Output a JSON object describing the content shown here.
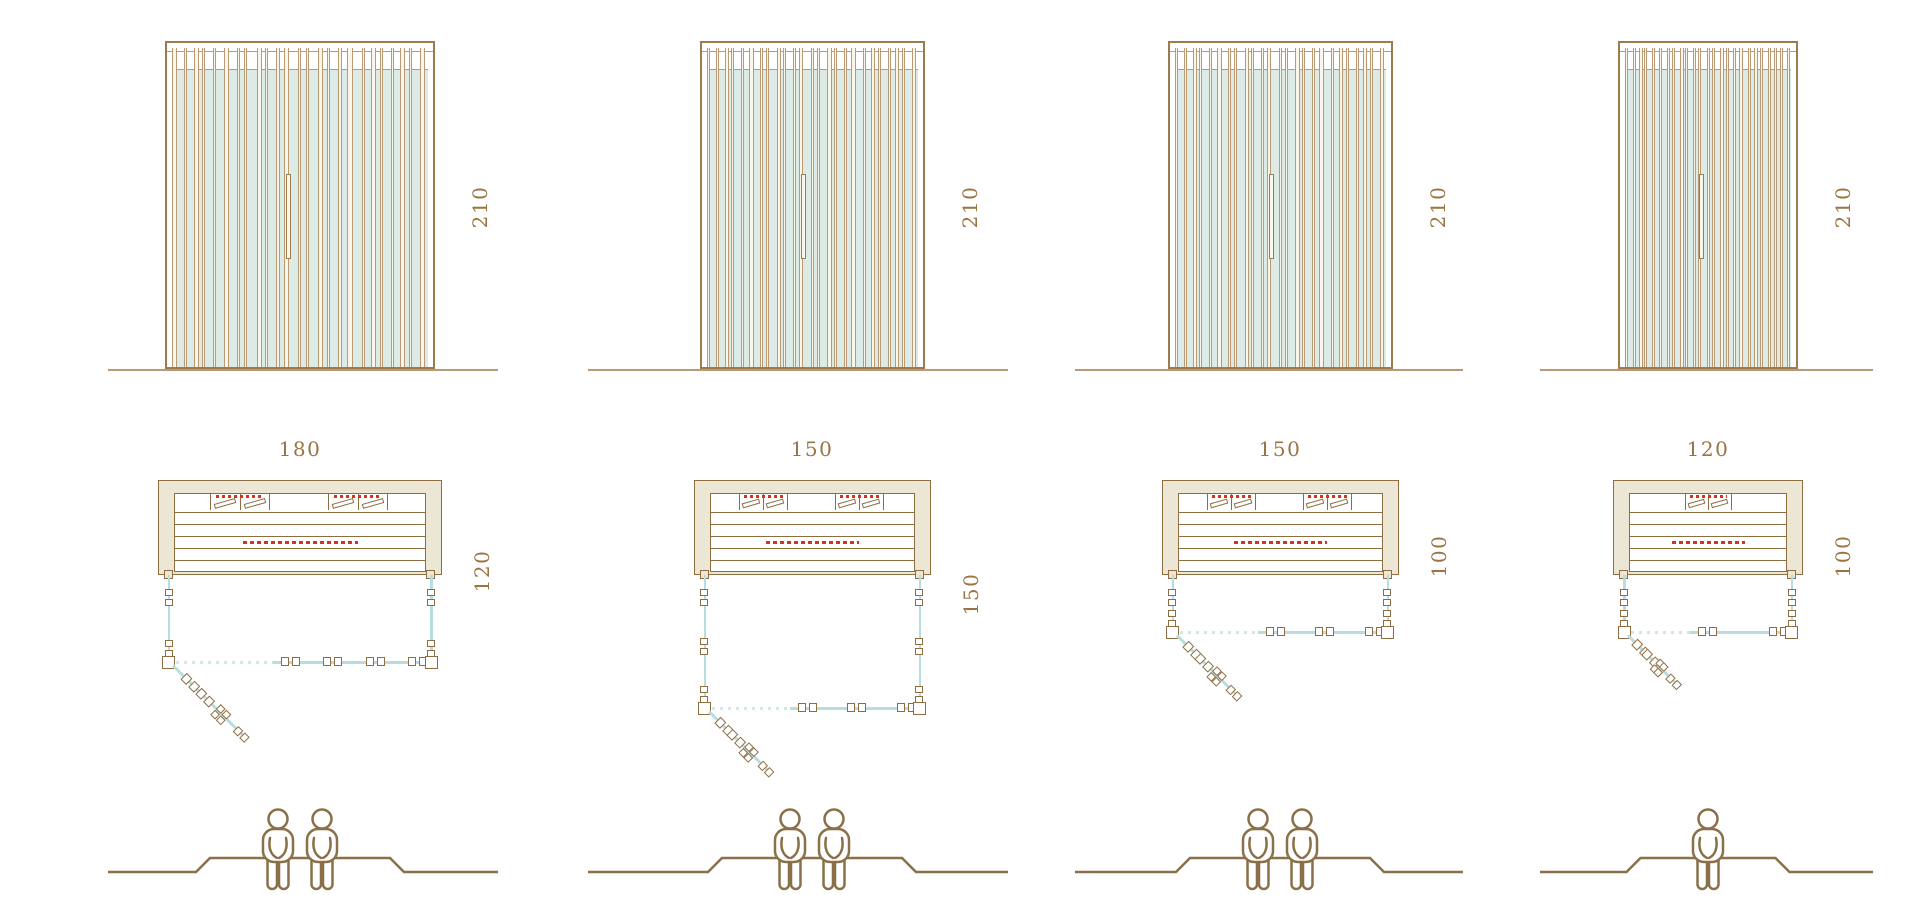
{
  "diagram": {
    "description": "Four sauna cabin size variants shown as front elevation, floor plan with glass front and door swing, and seating capacity figures",
    "cabins": [
      {
        "name": "cabin-180x120",
        "height_label": "210",
        "width_label": "180",
        "depth_label": "120",
        "height_cm": 210,
        "width_cm": 180,
        "depth_cm": 120,
        "seats": 2,
        "backrests": 2
      },
      {
        "name": "cabin-150x150",
        "height_label": "210",
        "width_label": "150",
        "depth_label": "150",
        "height_cm": 210,
        "width_cm": 150,
        "depth_cm": 150,
        "seats": 2,
        "backrests": 2
      },
      {
        "name": "cabin-150x100",
        "height_label": "210",
        "width_label": "150",
        "depth_label": "100",
        "height_cm": 210,
        "width_cm": 150,
        "depth_cm": 100,
        "seats": 2,
        "backrests": 2
      },
      {
        "name": "cabin-120x100",
        "height_label": "210",
        "width_label": "120",
        "depth_label": "100",
        "height_cm": 210,
        "width_cm": 120,
        "depth_cm": 100,
        "seats": 1,
        "backrests": 1
      }
    ],
    "colors": {
      "wood_line": "#9c7c4f",
      "wood_light": "#b99a74",
      "glass_fill": "#dcebe6",
      "panel_fill": "#ece7d4",
      "plan_line": "#8e6e41",
      "glass_line": "#b8dde1",
      "glass_dotted": "#cfe8ea",
      "heater_red": "#d7321f",
      "label_text": "#9a7443",
      "figure_line": "#8a7048"
    }
  }
}
